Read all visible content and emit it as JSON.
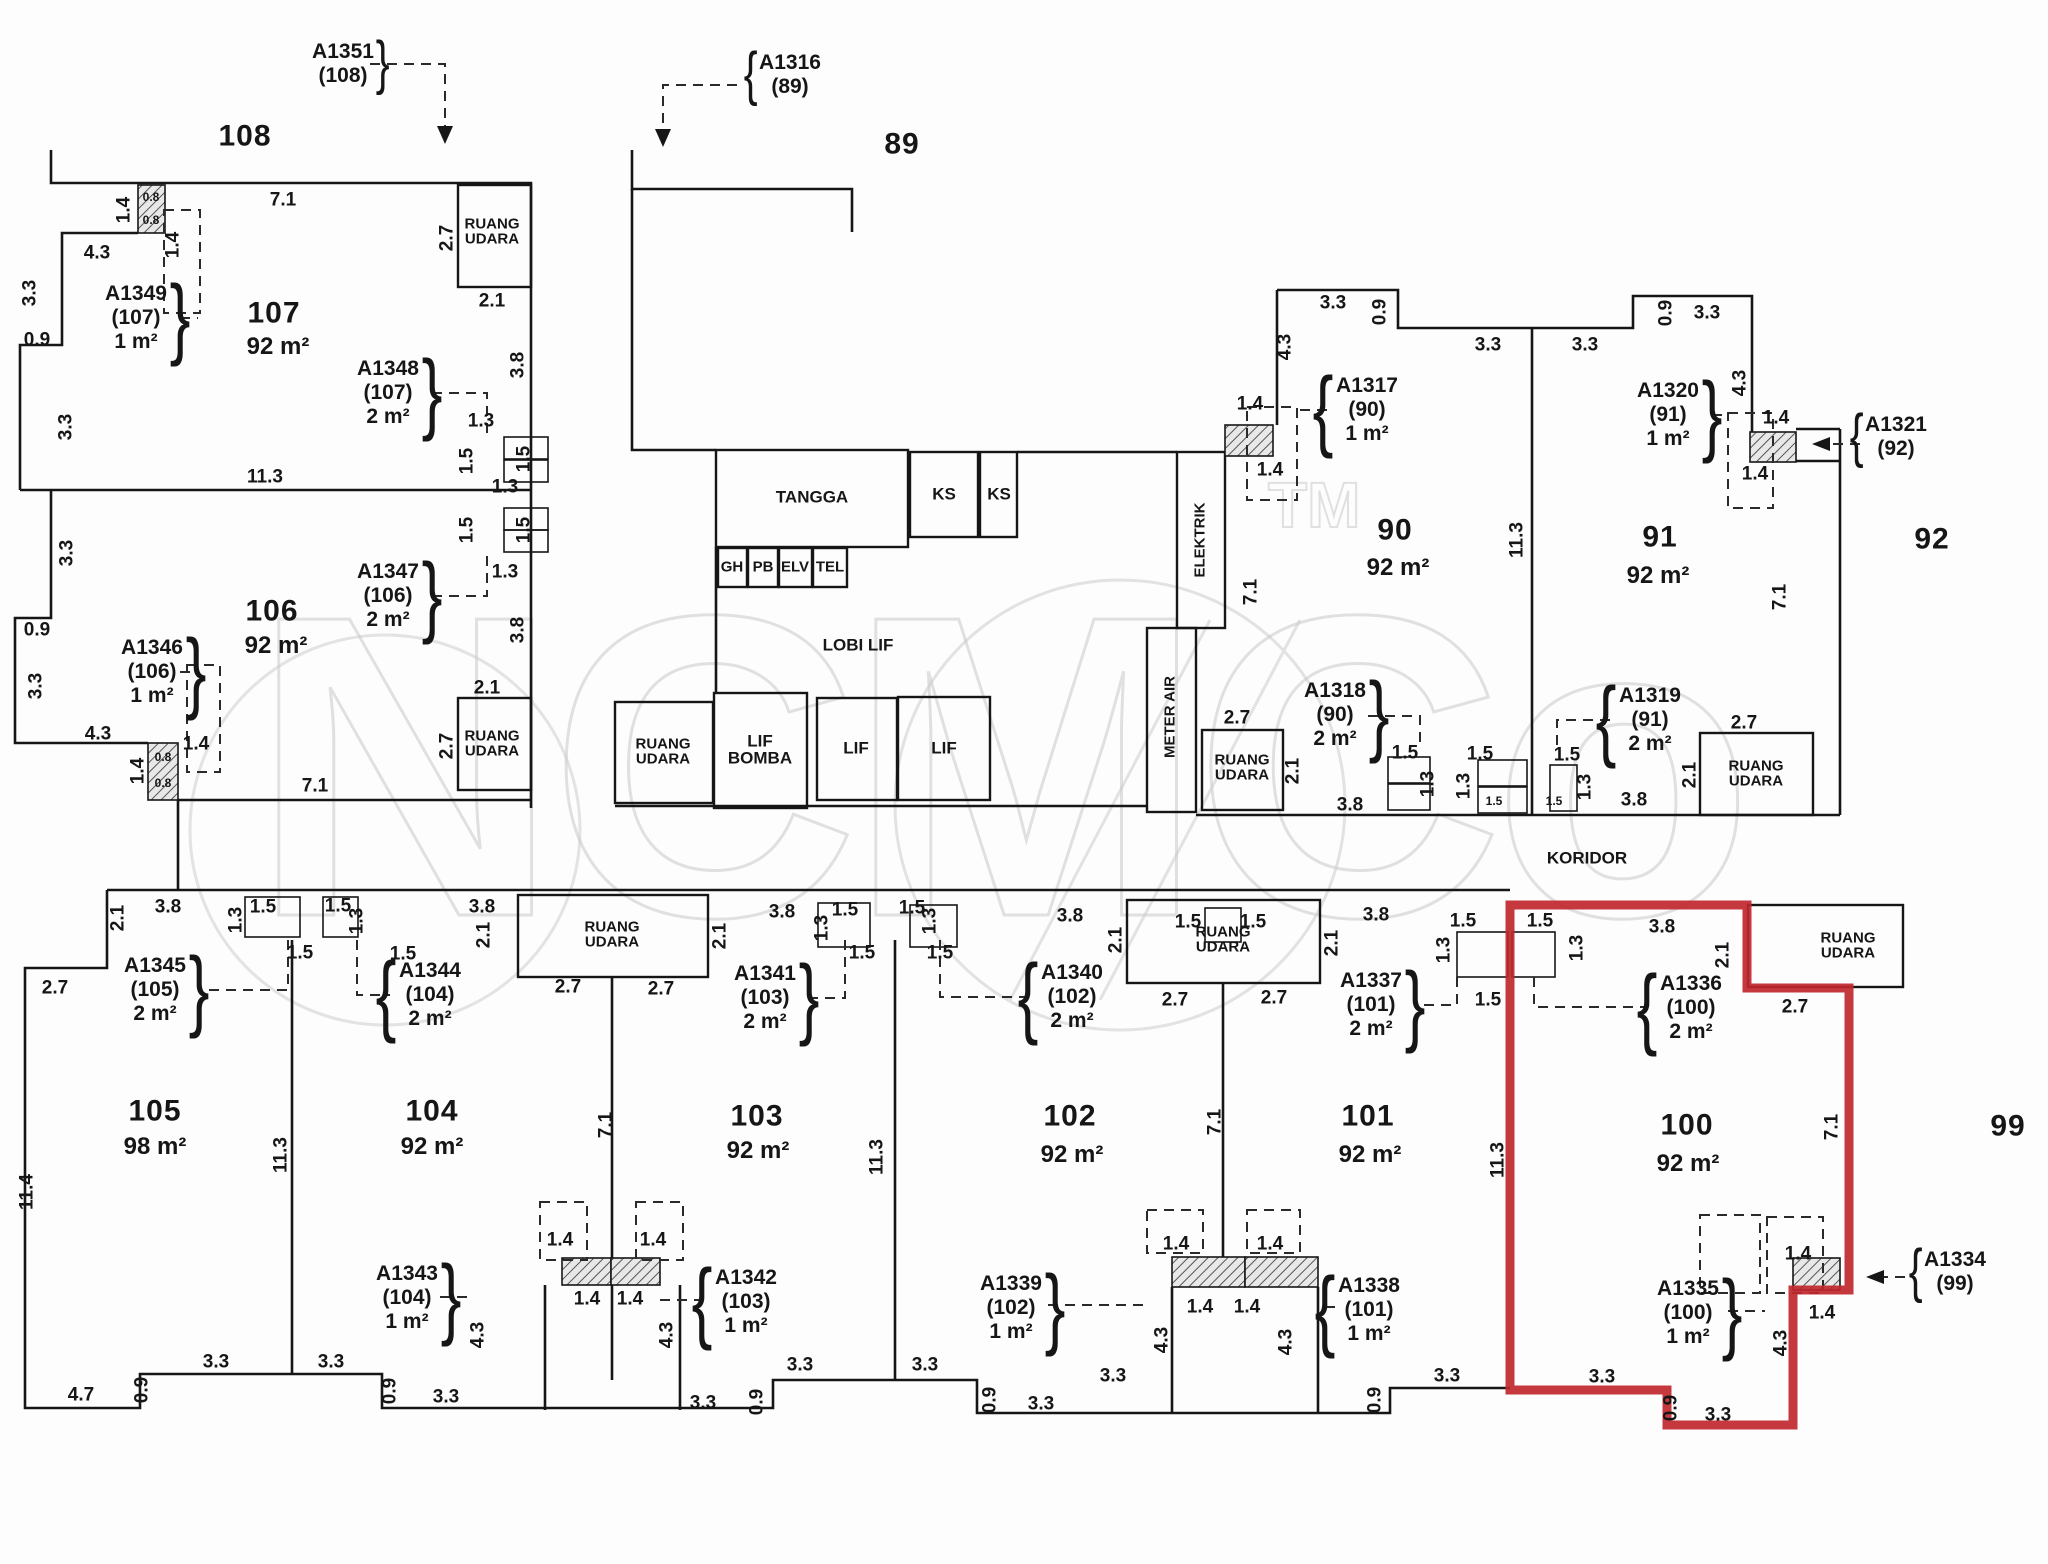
{
  "title": "Strata floor plan — units 89-92 and 99-108 (unit 100 highlighted)",
  "watermark": {
    "text": "NCMCo",
    "tm": "TM"
  },
  "highlight": {
    "unit": "100",
    "color": "#c0272d"
  },
  "wall_color": "#161616",
  "units": [
    {
      "no": "108",
      "x": 245,
      "y": 137
    },
    {
      "no": "89",
      "x": 902,
      "y": 145
    },
    {
      "no": "107",
      "x": 274,
      "y": 314,
      "area": "92 m²",
      "ax": 278,
      "ay": 347
    },
    {
      "no": "106",
      "x": 272,
      "y": 612,
      "area": "92 m²",
      "ax": 276,
      "ay": 646
    },
    {
      "no": "90",
      "x": 1395,
      "y": 531,
      "area": "92 m²",
      "ax": 1398,
      "ay": 568
    },
    {
      "no": "91",
      "x": 1660,
      "y": 538,
      "area": "92 m²",
      "ax": 1658,
      "ay": 576
    },
    {
      "no": "92",
      "x": 1932,
      "y": 540
    },
    {
      "no": "105",
      "x": 155,
      "y": 1112,
      "area": "98 m²",
      "ax": 155,
      "ay": 1147
    },
    {
      "no": "104",
      "x": 432,
      "y": 1112,
      "area": "92 m²",
      "ax": 432,
      "ay": 1147
    },
    {
      "no": "103",
      "x": 757,
      "y": 1117,
      "area": "92 m²",
      "ax": 758,
      "ay": 1151
    },
    {
      "no": "102",
      "x": 1070,
      "y": 1117,
      "area": "92 m²",
      "ax": 1072,
      "ay": 1155
    },
    {
      "no": "101",
      "x": 1368,
      "y": 1117,
      "area": "92 m²",
      "ax": 1370,
      "ay": 1155
    },
    {
      "no": "100",
      "x": 1687,
      "y": 1126,
      "area": "92 m²",
      "ax": 1688,
      "ay": 1164
    },
    {
      "no": "99",
      "x": 2008,
      "y": 1127
    }
  ],
  "rooms": [
    {
      "name": "ruang-udara",
      "lines": [
        "RUANG",
        "UDARA"
      ],
      "x": 492,
      "y": 232
    },
    {
      "name": "ruang-udara",
      "lines": [
        "RUANG",
        "UDARA"
      ],
      "x": 492,
      "y": 744
    },
    {
      "name": "ruang-udara",
      "lines": [
        "RUANG",
        "UDARA"
      ],
      "x": 663,
      "y": 752
    },
    {
      "name": "ruang-udara",
      "lines": [
        "RUANG",
        "UDARA"
      ],
      "x": 1242,
      "y": 768
    },
    {
      "name": "ruang-udara",
      "lines": [
        "RUANG",
        "UDARA"
      ],
      "x": 1756,
      "y": 774
    },
    {
      "name": "ruang-udara",
      "lines": [
        "RUANG",
        "UDARA"
      ],
      "x": 1848,
      "y": 946
    },
    {
      "name": "ruang-udara",
      "lines": [
        "RUANG",
        "UDARA"
      ],
      "x": 612,
      "y": 935
    },
    {
      "name": "ruang-udara",
      "lines": [
        "RUANG",
        "UDARA"
      ],
      "x": 1223,
      "y": 940
    },
    {
      "name": "tangga",
      "lines": [
        "TANGGA"
      ],
      "x": 812,
      "y": 497,
      "big": true
    },
    {
      "name": "ks",
      "lines": [
        "KS"
      ],
      "x": 944,
      "y": 494,
      "big": true
    },
    {
      "name": "ks",
      "lines": [
        "KS"
      ],
      "x": 999,
      "y": 494,
      "big": true
    },
    {
      "name": "gh",
      "lines": [
        "GH"
      ],
      "x": 732,
      "y": 567
    },
    {
      "name": "pb",
      "lines": [
        "PB"
      ],
      "x": 763,
      "y": 567
    },
    {
      "name": "elv",
      "lines": [
        "ELV"
      ],
      "x": 795,
      "y": 567
    },
    {
      "name": "tel",
      "lines": [
        "TEL"
      ],
      "x": 830,
      "y": 567
    },
    {
      "name": "lobi-lif",
      "lines": [
        "LOBI LIF"
      ],
      "x": 858,
      "y": 645,
      "big": true
    },
    {
      "name": "lif-bomba",
      "lines": [
        "LIF",
        "BOMBA"
      ],
      "x": 760,
      "y": 750,
      "big": true
    },
    {
      "name": "lif",
      "lines": [
        "LIF"
      ],
      "x": 856,
      "y": 748,
      "big": true
    },
    {
      "name": "lif",
      "lines": [
        "LIF"
      ],
      "x": 944,
      "y": 748,
      "big": true
    },
    {
      "name": "elektrik",
      "lines": [
        "ELEKTRIK"
      ],
      "x": 1200,
      "y": 540,
      "rot": true
    },
    {
      "name": "meter-air",
      "lines": [
        "METER AIR"
      ],
      "x": 1170,
      "y": 717,
      "rot": true
    },
    {
      "name": "koridor",
      "lines": [
        "KORIDOR"
      ],
      "x": 1587,
      "y": 858,
      "big": true
    }
  ],
  "callouts": [
    {
      "id": "A1351",
      "unit": "(108)",
      "x": 343,
      "y": 64,
      "brace": "}"
    },
    {
      "id": "A1316",
      "unit": "(89)",
      "x": 790,
      "y": 75,
      "brace": "{"
    },
    {
      "id": "A1349",
      "unit": "(107)",
      "area": "1 m²",
      "x": 136,
      "y": 318,
      "brace": "}"
    },
    {
      "id": "A1348",
      "unit": "(107)",
      "area": "2 m²",
      "x": 388,
      "y": 393,
      "brace": "}"
    },
    {
      "id": "A1347",
      "unit": "(106)",
      "area": "2 m²",
      "x": 388,
      "y": 596,
      "brace": "}"
    },
    {
      "id": "A1346",
      "unit": "(106)",
      "area": "1 m²",
      "x": 152,
      "y": 672,
      "brace": "}"
    },
    {
      "id": "A1317",
      "unit": "(90)",
      "area": "1 m²",
      "x": 1367,
      "y": 410,
      "brace": "{"
    },
    {
      "id": "A1320",
      "unit": "(91)",
      "area": "1 m²",
      "x": 1668,
      "y": 415,
      "brace": "}"
    },
    {
      "id": "A1321",
      "unit": "(92)",
      "x": 1896,
      "y": 437,
      "brace": "{"
    },
    {
      "id": "A1318",
      "unit": "(90)",
      "area": "2 m²",
      "x": 1335,
      "y": 715,
      "brace": "}"
    },
    {
      "id": "A1319",
      "unit": "(91)",
      "area": "2 m²",
      "x": 1650,
      "y": 720,
      "brace": "{"
    },
    {
      "id": "A1345",
      "unit": "(105)",
      "area": "2 m²",
      "x": 155,
      "y": 990,
      "brace": "}"
    },
    {
      "id": "A1344",
      "unit": "(104)",
      "area": "2 m²",
      "x": 430,
      "y": 995,
      "brace": "{"
    },
    {
      "id": "A1341",
      "unit": "(103)",
      "area": "2 m²",
      "x": 765,
      "y": 998,
      "brace": "}"
    },
    {
      "id": "A1340",
      "unit": "(102)",
      "area": "2 m²",
      "x": 1072,
      "y": 997,
      "brace": "{"
    },
    {
      "id": "A1337",
      "unit": "(101)",
      "area": "2 m²",
      "x": 1371,
      "y": 1005,
      "brace": "}"
    },
    {
      "id": "A1336",
      "unit": "(100)",
      "area": "2 m²",
      "x": 1691,
      "y": 1008,
      "brace": "{"
    },
    {
      "id": "A1343",
      "unit": "(104)",
      "area": "1 m²",
      "x": 407,
      "y": 1298,
      "brace": "}"
    },
    {
      "id": "A1342",
      "unit": "(103)",
      "area": "1 m²",
      "x": 746,
      "y": 1302,
      "brace": "{"
    },
    {
      "id": "A1339",
      "unit": "(102)",
      "area": "1 m²",
      "x": 1011,
      "y": 1308,
      "brace": "}"
    },
    {
      "id": "A1338",
      "unit": "(101)",
      "area": "1 m²",
      "x": 1369,
      "y": 1310,
      "brace": "{"
    },
    {
      "id": "A1335",
      "unit": "(100)",
      "area": "1 m²",
      "x": 1688,
      "y": 1313,
      "brace": "}"
    },
    {
      "id": "A1334",
      "unit": "(99)",
      "x": 1955,
      "y": 1272,
      "brace": "{"
    }
  ],
  "dims": [
    {
      "t": "7.1",
      "x": 283,
      "y": 200
    },
    {
      "t": "1.4",
      "x": 124,
      "y": 210,
      "r": 1
    },
    {
      "t": "0.8",
      "x": 151,
      "y": 197,
      "s": 1
    },
    {
      "t": "0.8",
      "x": 151,
      "y": 220,
      "s": 1
    },
    {
      "t": "1.4",
      "x": 173,
      "y": 245,
      "r": 1
    },
    {
      "t": "4.3",
      "x": 97,
      "y": 253
    },
    {
      "t": "3.3",
      "x": 30,
      "y": 293,
      "r": 1
    },
    {
      "t": "0.9",
      "x": 37,
      "y": 340
    },
    {
      "t": "11.3",
      "x": 265,
      "y": 477
    },
    {
      "t": "3.3",
      "x": 66,
      "y": 427,
      "r": 1
    },
    {
      "t": "3.3",
      "x": 67,
      "y": 553,
      "r": 1
    },
    {
      "t": "0.9",
      "x": 37,
      "y": 630
    },
    {
      "t": "3.3",
      "x": 36,
      "y": 686,
      "r": 1
    },
    {
      "t": "4.3",
      "x": 98,
      "y": 734
    },
    {
      "t": "1.4",
      "x": 138,
      "y": 771,
      "r": 1
    },
    {
      "t": "0.8",
      "x": 163,
      "y": 757,
      "s": 1
    },
    {
      "t": "0.8",
      "x": 163,
      "y": 783,
      "s": 1
    },
    {
      "t": "1.4",
      "x": 196,
      "y": 744
    },
    {
      "t": "7.1",
      "x": 315,
      "y": 786
    },
    {
      "t": "2.7",
      "x": 447,
      "y": 238,
      "r": 1
    },
    {
      "t": "2.1",
      "x": 492,
      "y": 301
    },
    {
      "t": "3.8",
      "x": 518,
      "y": 365,
      "r": 1
    },
    {
      "t": "1.3",
      "x": 481,
      "y": 421
    },
    {
      "t": "1.5",
      "x": 467,
      "y": 461,
      "r": 1
    },
    {
      "t": "1.5",
      "x": 524,
      "y": 459,
      "r": 1
    },
    {
      "t": "1.3",
      "x": 505,
      "y": 487
    },
    {
      "t": "1.5",
      "x": 467,
      "y": 530,
      "r": 1
    },
    {
      "t": "1.5",
      "x": 524,
      "y": 530,
      "r": 1
    },
    {
      "t": "1.3",
      "x": 505,
      "y": 572
    },
    {
      "t": "3.8",
      "x": 518,
      "y": 630,
      "r": 1
    },
    {
      "t": "2.1",
      "x": 487,
      "y": 688
    },
    {
      "t": "2.7",
      "x": 447,
      "y": 746,
      "r": 1
    },
    {
      "t": "3.3",
      "x": 1333,
      "y": 303
    },
    {
      "t": "0.9",
      "x": 1380,
      "y": 312,
      "r": 1
    },
    {
      "t": "4.3",
      "x": 1285,
      "y": 347,
      "r": 1
    },
    {
      "t": "1.4",
      "x": 1250,
      "y": 404
    },
    {
      "t": "1.4",
      "x": 1270,
      "y": 470
    },
    {
      "t": "7.1",
      "x": 1251,
      "y": 592,
      "r": 1
    },
    {
      "t": "3.3",
      "x": 1488,
      "y": 345
    },
    {
      "t": "3.3",
      "x": 1585,
      "y": 345
    },
    {
      "t": "0.9",
      "x": 1666,
      "y": 313,
      "r": 1
    },
    {
      "t": "3.3",
      "x": 1707,
      "y": 313
    },
    {
      "t": "4.3",
      "x": 1740,
      "y": 383,
      "r": 1
    },
    {
      "t": "1.4",
      "x": 1776,
      "y": 418
    },
    {
      "t": "1.4",
      "x": 1755,
      "y": 474
    },
    {
      "t": "11.3",
      "x": 1517,
      "y": 540,
      "r": 1
    },
    {
      "t": "7.1",
      "x": 1780,
      "y": 597,
      "r": 1
    },
    {
      "t": "2.7",
      "x": 1237,
      "y": 718
    },
    {
      "t": "2.1",
      "x": 1293,
      "y": 771,
      "r": 1
    },
    {
      "t": "3.8",
      "x": 1350,
      "y": 805
    },
    {
      "t": "1.5",
      "x": 1405,
      "y": 753
    },
    {
      "t": "1.3",
      "x": 1428,
      "y": 784,
      "r": 1
    },
    {
      "t": "1.5",
      "x": 1480,
      "y": 754
    },
    {
      "t": "1.3",
      "x": 1464,
      "y": 786,
      "r": 1
    },
    {
      "t": "1.5",
      "x": 1494,
      "y": 801,
      "s": 1
    },
    {
      "t": "1.5",
      "x": 1567,
      "y": 755
    },
    {
      "t": "1.3",
      "x": 1585,
      "y": 787,
      "r": 1
    },
    {
      "t": "1.5",
      "x": 1554,
      "y": 801,
      "s": 1
    },
    {
      "t": "3.8",
      "x": 1634,
      "y": 800
    },
    {
      "t": "2.7",
      "x": 1744,
      "y": 723
    },
    {
      "t": "2.1",
      "x": 1690,
      "y": 775,
      "r": 1
    },
    {
      "t": "2.1",
      "x": 118,
      "y": 918,
      "r": 1
    },
    {
      "t": "3.8",
      "x": 168,
      "y": 907
    },
    {
      "t": "1.3",
      "x": 236,
      "y": 920,
      "r": 1
    },
    {
      "t": "1.5",
      "x": 263,
      "y": 907
    },
    {
      "t": "1.5",
      "x": 300,
      "y": 953
    },
    {
      "t": "1.5",
      "x": 338,
      "y": 906
    },
    {
      "t": "1.3",
      "x": 357,
      "y": 921,
      "r": 1
    },
    {
      "t": "1.5",
      "x": 403,
      "y": 954
    },
    {
      "t": "3.8",
      "x": 482,
      "y": 907
    },
    {
      "t": "2.1",
      "x": 484,
      "y": 935,
      "r": 1
    },
    {
      "t": "2.1",
      "x": 720,
      "y": 936,
      "r": 1
    },
    {
      "t": "2.7",
      "x": 568,
      "y": 987
    },
    {
      "t": "2.7",
      "x": 661,
      "y": 989
    },
    {
      "t": "3.8",
      "x": 782,
      "y": 912
    },
    {
      "t": "1.5",
      "x": 845,
      "y": 910
    },
    {
      "t": "1.3",
      "x": 822,
      "y": 928,
      "r": 1
    },
    {
      "t": "1.5",
      "x": 862,
      "y": 953
    },
    {
      "t": "1.5",
      "x": 912,
      "y": 908
    },
    {
      "t": "1.3",
      "x": 930,
      "y": 921,
      "r": 1
    },
    {
      "t": "1.5",
      "x": 940,
      "y": 953
    },
    {
      "t": "3.8",
      "x": 1070,
      "y": 916
    },
    {
      "t": "2.1",
      "x": 1116,
      "y": 940,
      "r": 1
    },
    {
      "t": "2.1",
      "x": 1332,
      "y": 943,
      "r": 1
    },
    {
      "t": "2.7",
      "x": 1175,
      "y": 1000
    },
    {
      "t": "2.7",
      "x": 1274,
      "y": 998
    },
    {
      "t": "1.5",
      "x": 1188,
      "y": 922
    },
    {
      "t": "1.5",
      "x": 1253,
      "y": 922
    },
    {
      "t": "3.8",
      "x": 1376,
      "y": 915
    },
    {
      "t": "1.5",
      "x": 1463,
      "y": 921
    },
    {
      "t": "1.3",
      "x": 1444,
      "y": 950,
      "r": 1
    },
    {
      "t": "1.5",
      "x": 1488,
      "y": 1000
    },
    {
      "t": "1.5",
      "x": 1540,
      "y": 921
    },
    {
      "t": "1.3",
      "x": 1577,
      "y": 948,
      "r": 1
    },
    {
      "t": "3.8",
      "x": 1662,
      "y": 927
    },
    {
      "t": "2.1",
      "x": 1723,
      "y": 955,
      "r": 1
    },
    {
      "t": "2.7",
      "x": 1795,
      "y": 1007
    },
    {
      "t": "11.4",
      "x": 27,
      "y": 1192,
      "r": 1
    },
    {
      "t": "2.7",
      "x": 55,
      "y": 988
    },
    {
      "t": "11.3",
      "x": 281,
      "y": 1155,
      "r": 1
    },
    {
      "t": "7.1",
      "x": 606,
      "y": 1125,
      "r": 1
    },
    {
      "t": "11.3",
      "x": 877,
      "y": 1157,
      "r": 1
    },
    {
      "t": "7.1",
      "x": 1215,
      "y": 1122,
      "r": 1
    },
    {
      "t": "11.3",
      "x": 1498,
      "y": 1160,
      "r": 1
    },
    {
      "t": "7.1",
      "x": 1832,
      "y": 1127,
      "r": 1
    },
    {
      "t": "4.7",
      "x": 81,
      "y": 1395
    },
    {
      "t": "0.9",
      "x": 142,
      "y": 1390,
      "r": 1
    },
    {
      "t": "3.3",
      "x": 216,
      "y": 1362
    },
    {
      "t": "3.3",
      "x": 331,
      "y": 1362
    },
    {
      "t": "0.9",
      "x": 390,
      "y": 1391,
      "r": 1
    },
    {
      "t": "3.3",
      "x": 446,
      "y": 1397
    },
    {
      "t": "1.4",
      "x": 560,
      "y": 1240
    },
    {
      "t": "1.4",
      "x": 653,
      "y": 1240
    },
    {
      "t": "1.4",
      "x": 587,
      "y": 1299
    },
    {
      "t": "1.4",
      "x": 630,
      "y": 1299
    },
    {
      "t": "4.3",
      "x": 478,
      "y": 1335,
      "r": 1
    },
    {
      "t": "4.3",
      "x": 667,
      "y": 1335,
      "r": 1
    },
    {
      "t": "3.3",
      "x": 703,
      "y": 1403
    },
    {
      "t": "0.9",
      "x": 757,
      "y": 1402,
      "r": 1
    },
    {
      "t": "3.3",
      "x": 800,
      "y": 1365
    },
    {
      "t": "3.3",
      "x": 925,
      "y": 1365
    },
    {
      "t": "0.9",
      "x": 990,
      "y": 1400,
      "r": 1
    },
    {
      "t": "3.3",
      "x": 1041,
      "y": 1404
    },
    {
      "t": "3.3",
      "x": 1113,
      "y": 1376
    },
    {
      "t": "1.4",
      "x": 1176,
      "y": 1244
    },
    {
      "t": "1.4",
      "x": 1270,
      "y": 1244
    },
    {
      "t": "1.4",
      "x": 1200,
      "y": 1307
    },
    {
      "t": "1.4",
      "x": 1247,
      "y": 1307
    },
    {
      "t": "4.3",
      "x": 1162,
      "y": 1340,
      "r": 1
    },
    {
      "t": "4.3",
      "x": 1286,
      "y": 1342,
      "r": 1
    },
    {
      "t": "0.9",
      "x": 1375,
      "y": 1400,
      "r": 1
    },
    {
      "t": "3.3",
      "x": 1447,
      "y": 1376
    },
    {
      "t": "3.3",
      "x": 1602,
      "y": 1377
    },
    {
      "t": "0.9",
      "x": 1671,
      "y": 1408,
      "r": 1
    },
    {
      "t": "3.3",
      "x": 1718,
      "y": 1415
    },
    {
      "t": "4.3",
      "x": 1781,
      "y": 1343,
      "r": 1
    },
    {
      "t": "1.4",
      "x": 1798,
      "y": 1254
    },
    {
      "t": "1.4",
      "x": 1822,
      "y": 1313
    }
  ]
}
